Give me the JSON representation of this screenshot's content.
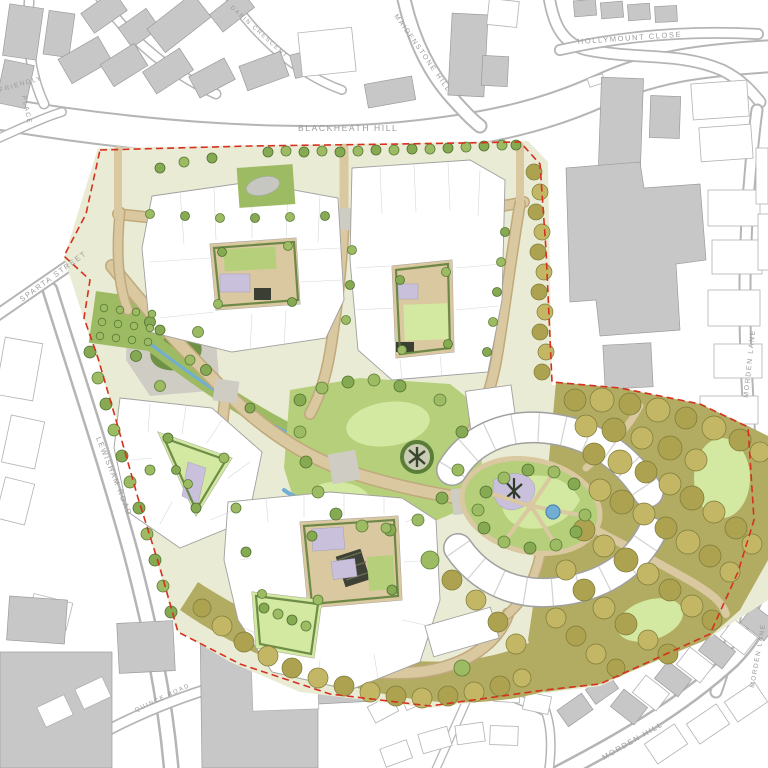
{
  "map": {
    "street_labels": {
      "blackheath_hill": "BLACKHEATH HILL",
      "maidenstone_hill": "MAIDENSTONE HILL",
      "hollymount_close": "HOLLYMOUNT CLOSE",
      "dabin_crescent": "DABIN CRESCENT",
      "friendly": "FRIENDLY",
      "place": "PLACE",
      "sparta_street": "SPARTA STREET",
      "lewisham_road": "LEWISHAM ROAD",
      "morden_lane": "MORDEN LANE",
      "morden_lane_south": "MORDEN LANE",
      "morden_hill": "MORDEN HILL",
      "quince_road": "QUINCE ROAD"
    },
    "palette": {
      "boundary_red": "#d6301f",
      "context_fill": "#c7c7c7",
      "context_stroke": "#9c9c9c",
      "outline_stroke": "#b2b2b2",
      "road_line": "#b5b5b5",
      "bldg_fill": "#ffffff",
      "bldg_stroke": "#a0a0a0",
      "street_tan": "#d9c8a0",
      "street_tan_dark": "#c0a97c",
      "paving_gray": "#cfccc3",
      "site_base": "#e9ebd4",
      "park_green": "#b5cf7b",
      "lawn_light": "#d3e8a0",
      "green_mid": "#9cbb62",
      "hedge_green": "#5a7d38",
      "tree_green": "#86aa52",
      "tree_green_dark": "#4f7030",
      "olive_base": "#b2ab62",
      "olive_tree_1": "#aca24f",
      "olive_tree_2": "#c3b766",
      "olive_tree_dark": "#7d7a36",
      "lavender": "#c9c0db",
      "water_blue": "#72aed4",
      "mound_green": "#6f9146",
      "label_gray": "#9b9b9b"
    }
  }
}
